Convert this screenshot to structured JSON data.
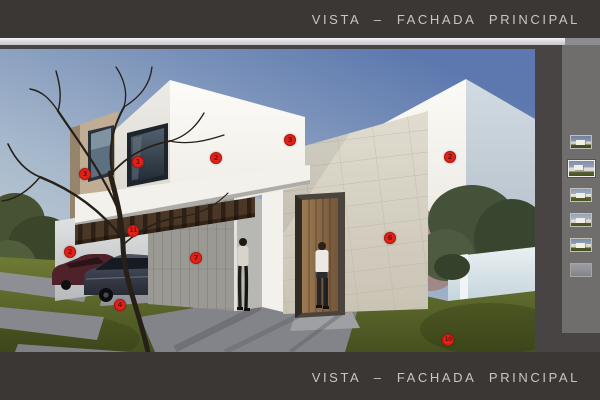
{
  "header": {
    "title": "VISTA – FACHADA PRINCIPAL"
  },
  "footer": {
    "title": "VISTA – FACHADA PRINCIPAL"
  },
  "render": {
    "markers": [
      {
        "label": "1",
        "x": 138,
        "y": 162
      },
      {
        "label": "2",
        "x": 216,
        "y": 158
      },
      {
        "label": "3",
        "x": 85,
        "y": 174
      },
      {
        "label": "3",
        "x": 290,
        "y": 140
      },
      {
        "label": "2",
        "x": 450,
        "y": 157
      },
      {
        "label": "2",
        "x": 70,
        "y": 252
      },
      {
        "label": "11",
        "x": 133,
        "y": 231
      },
      {
        "label": "7",
        "x": 196,
        "y": 258
      },
      {
        "label": "4",
        "x": 120,
        "y": 305,
        "leader": true
      },
      {
        "label": "6",
        "x": 390,
        "y": 238
      },
      {
        "label": "10",
        "x": 448,
        "y": 340
      }
    ]
  },
  "sidebar": {
    "thumbnails": [
      {
        "name": "view-thumbnail-1",
        "selected": false
      },
      {
        "name": "view-thumbnail-2",
        "selected": true
      },
      {
        "name": "view-thumbnail-3",
        "selected": false
      },
      {
        "name": "view-thumbnail-4",
        "selected": false
      },
      {
        "name": "view-thumbnail-5",
        "selected": false
      },
      {
        "name": "view-thumbnail-6",
        "selected": false
      }
    ]
  },
  "colors": {
    "bar": "#3b3734",
    "strip": "#d8d7db",
    "sidebar_bg": "#6f6e6c",
    "gap": "#474443",
    "title_text": "#c8c6c4",
    "marker": "#e02318",
    "marker_text": "#6f100d"
  }
}
